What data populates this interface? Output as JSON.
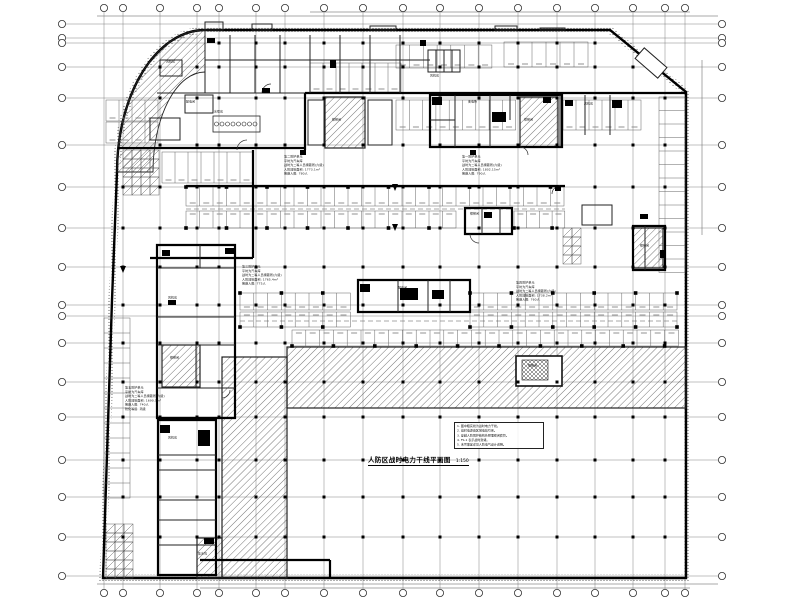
{
  "drawing": {
    "title": "人防区战时电力干线平面图",
    "title_scale": "1:150",
    "units": [
      {
        "name": "第二防护单元",
        "lines": [
          "第二防护单元",
          "平时为汽车库",
          "战时为二等人员掩蔽所(六级)",
          "人防建筑面积: 1773.1m²",
          "掩蔽人数: 780人"
        ]
      },
      {
        "name": "第一防护单元",
        "lines": [
          "第一防护单元",
          "平时为汽车库",
          "战时为二等人员掩蔽所(六级)",
          "人防建筑面积: 1802.15m²",
          "掩蔽人数: 790人"
        ]
      },
      {
        "name": "第三防护单元",
        "lines": [
          "第三防护单元",
          "平时为汽车库",
          "战时为二等人员掩蔽所(六级)",
          "人防建筑面积: 1765.4m²",
          "掩蔽人数: 775人"
        ]
      },
      {
        "name": "第四防护单元",
        "lines": [
          "第四防护单元",
          "平时为汽车库",
          "战时为二等人员掩蔽所(六级)",
          "人防建筑面积: 1738.2m²",
          "掩蔽人数: 760人"
        ]
      },
      {
        "name": "第五防护单元",
        "lines": [
          "第五防护单元",
          "平时为汽车库",
          "战时为二等人员掩蔽所(六级)",
          "人防建筑面积: 1690.5m²",
          "掩蔽人数: 740人",
          "防化等级: 丙级"
        ]
      }
    ],
    "notes": {
      "lines": [
        "1. 图中粗实线为战时电力干线。",
        "2. 战时电源由区域电站引来。",
        "3. 穿越人防围护结构处预埋密闭套管。",
        "4. FS-1 表示战时封堵。",
        "5. 未尽事宜详见人防电气设计说明。"
      ]
    },
    "room_labels": [
      "风机房",
      "配电间",
      "水泵房",
      "楼梯间",
      "风机房",
      "变电所",
      "楼梯间",
      "风机房",
      "楼梯间",
      "配电间",
      "风机房",
      "楼梯间",
      "楼梯间",
      "风机房",
      "集水坑",
      "楼梯间"
    ]
  },
  "colors": {
    "background": "#ffffff",
    "line": "#1a1a1a",
    "light_line": "#555555",
    "hatch_line": "#3a3a3a"
  }
}
